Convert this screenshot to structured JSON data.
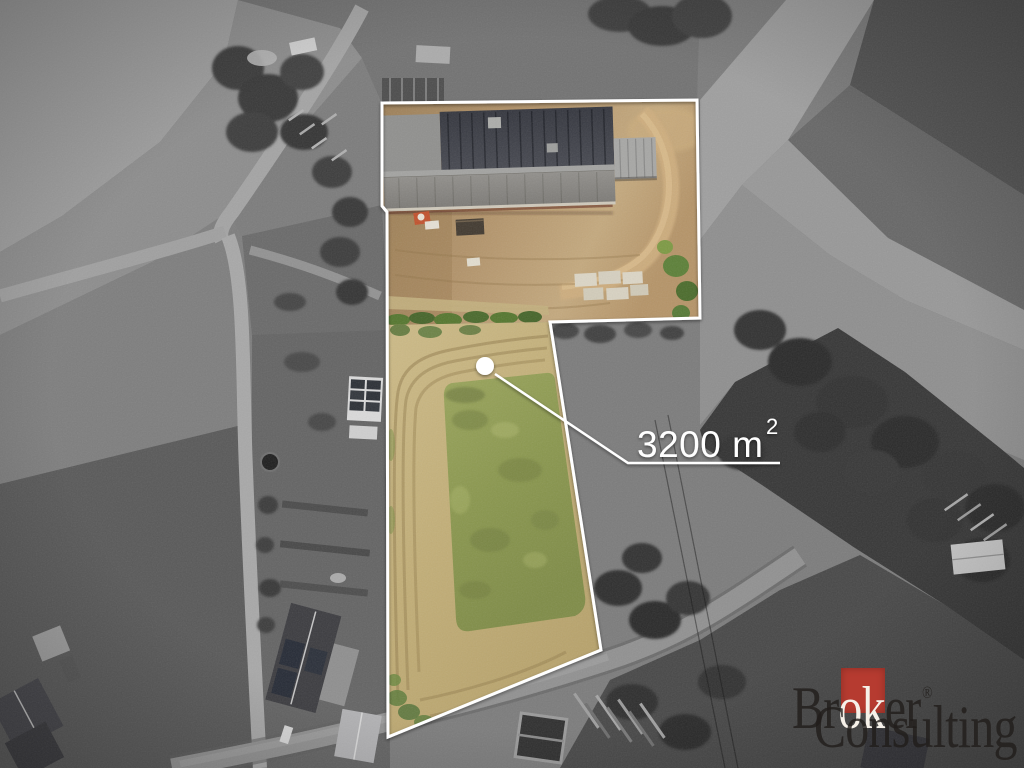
{
  "annotation": {
    "full_label": "3200 m²",
    "area_value": "3200 m",
    "area_exponent": "2"
  },
  "watermark": {
    "brand_full": "Broker Consulting®",
    "brand_part1": "Br",
    "brand_part2": "ok",
    "brand_part3": "er",
    "registered_mark": "®",
    "brand_line2": "Consulting",
    "accent_color": "#b63b30"
  },
  "scene": {
    "palette": {
      "outline": "#ffffff",
      "marker_dot": "#ffffff",
      "dry_grass": "#c2ae77",
      "green_grass": "#8a974e",
      "dirt": "#b2936a",
      "barn_roof_dark": "#383a42",
      "barn_roof_light": "#8a8884",
      "monochrome_field": "#7c7c7c"
    }
  }
}
